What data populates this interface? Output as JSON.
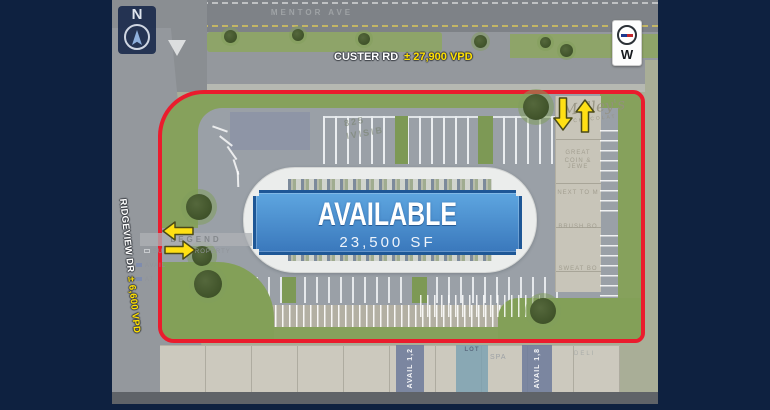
{
  "plan": {
    "compass_n": "N",
    "compass_w": "W",
    "roads": {
      "mentor_ave": "MENTOR AVE",
      "custer_rd": "CUSTER RD",
      "custer_vpd": "± 27,900 VPD",
      "ridgeview_dr": "RIDGEVIEW DR",
      "ridgeview_vpd": "± 6,600 VPD"
    },
    "banner": {
      "title": "AVAILABLE",
      "area": "23,500 SF"
    },
    "legend": {
      "title": "LEGEND",
      "subject": "SUBJECT PROPERTY",
      "avail": "AVAIL",
      "at": "AT"
    },
    "ghost": {
      "divisible1": "825",
      "divisible2": "IVISIB",
      "malley": "Malley's",
      "malley_sub": "CHOCOLAT",
      "great": "GREAT",
      "coin": "COIN & JEWE",
      "next_to": "NEXT TO M",
      "brush": "BRUSH BO",
      "sweat": "SWEAT BO"
    },
    "shops": {
      "avail1": "AVAIL 1,2",
      "lot": "LOT",
      "spa": "SPA",
      "avail2": "AVAIL 1,8",
      "deli": "DELI"
    },
    "colors": {
      "frame_navy": "#0e2140",
      "outline_red": "#ea1c2d",
      "grass_green": "#86a15c",
      "banner_blue_top": "#5ea6e0",
      "banner_blue_bottom": "#3a78bc",
      "banner_border": "#1e5796",
      "arrow_yellow": "#ffe014",
      "vpd_yellow": "#ffe000"
    }
  }
}
